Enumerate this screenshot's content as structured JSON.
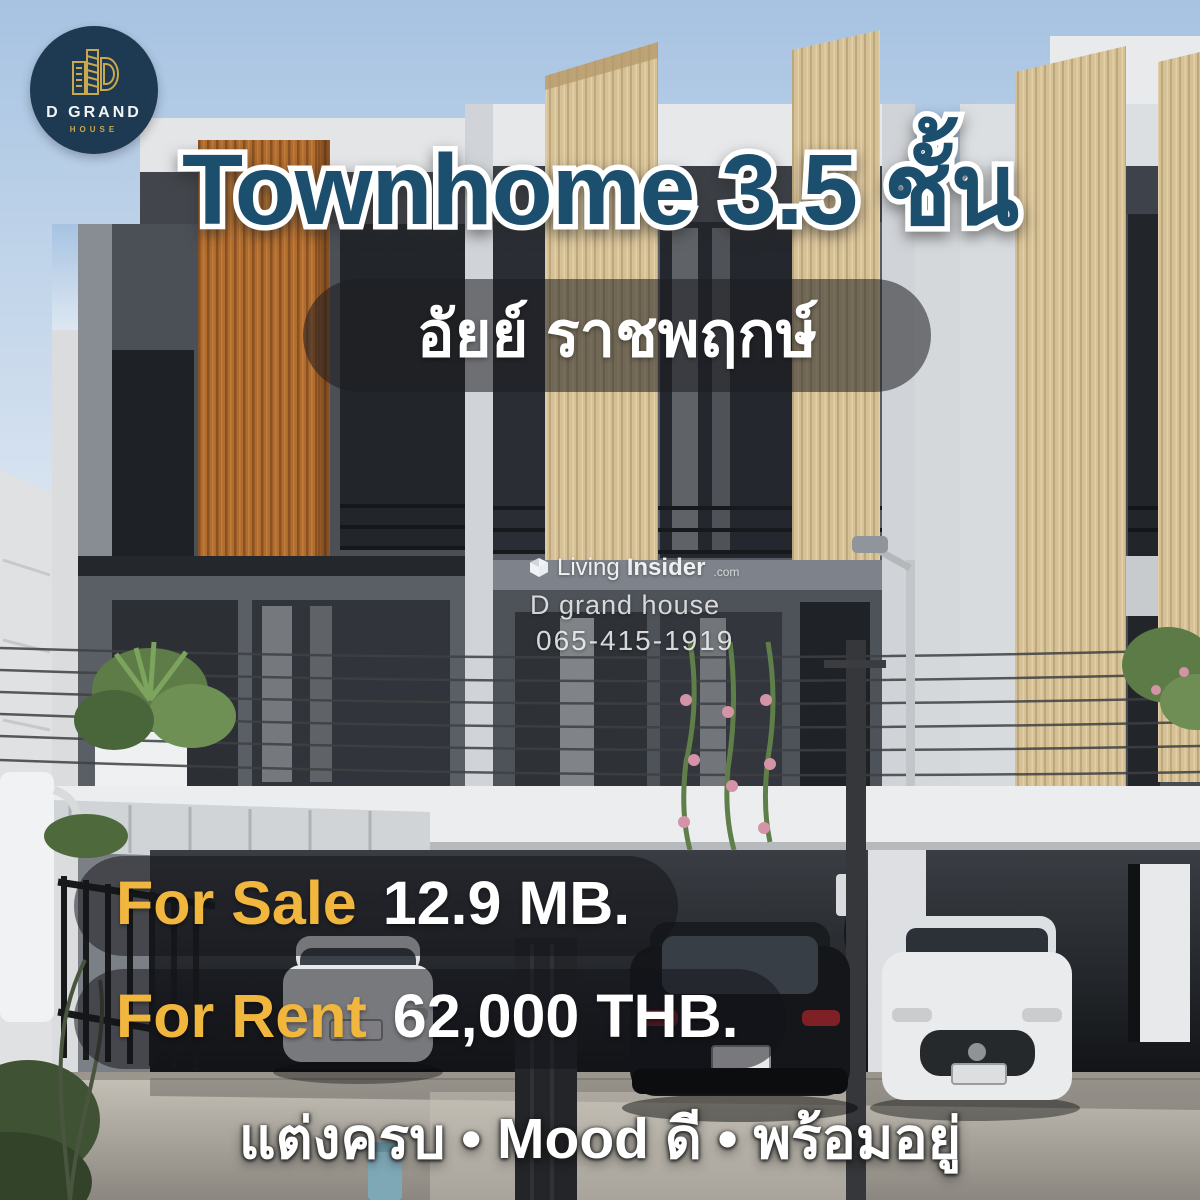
{
  "brand_badge": {
    "name_line1": "D GRAND",
    "name_line2": "HOUSE",
    "icon": "buildings-line-icon",
    "bg_color": "#1d3a52",
    "accent_color": "#c9a84e"
  },
  "headline": {
    "text": "Townhome 3.5 ชั้น",
    "fill_color": "#1c4e6e",
    "outline_color": "#ffffff"
  },
  "project_pill": {
    "text": "อัยย์ ราชพฤกษ์"
  },
  "watermark": {
    "icon": "living-insider-cube-icon",
    "brand_light": "Living",
    "brand_bold": "Insider",
    "brand_suffix": ".com",
    "agency": "D grand house",
    "phone": "065-415-1919"
  },
  "price_badges": [
    {
      "label": "For Sale",
      "value": "12.9 MB."
    },
    {
      "label": "For Rent",
      "value": "62,000 THB."
    }
  ],
  "badge_colors": {
    "label": "#f1b63e",
    "value": "#ffffff",
    "pill_bg": "rgba(20,20,24,0.52)"
  },
  "tagline": {
    "text": "แต่งครบ • Mood ดี • พร้อมอยู่"
  },
  "scene": {
    "subject": "modern 3.5-storey townhome row with wood-slat fins, carports and parked cars",
    "sky_color": "#a7c3e2",
    "orange_wood_color": "#b06c2e",
    "beige_wood_color": "#d6c096"
  }
}
